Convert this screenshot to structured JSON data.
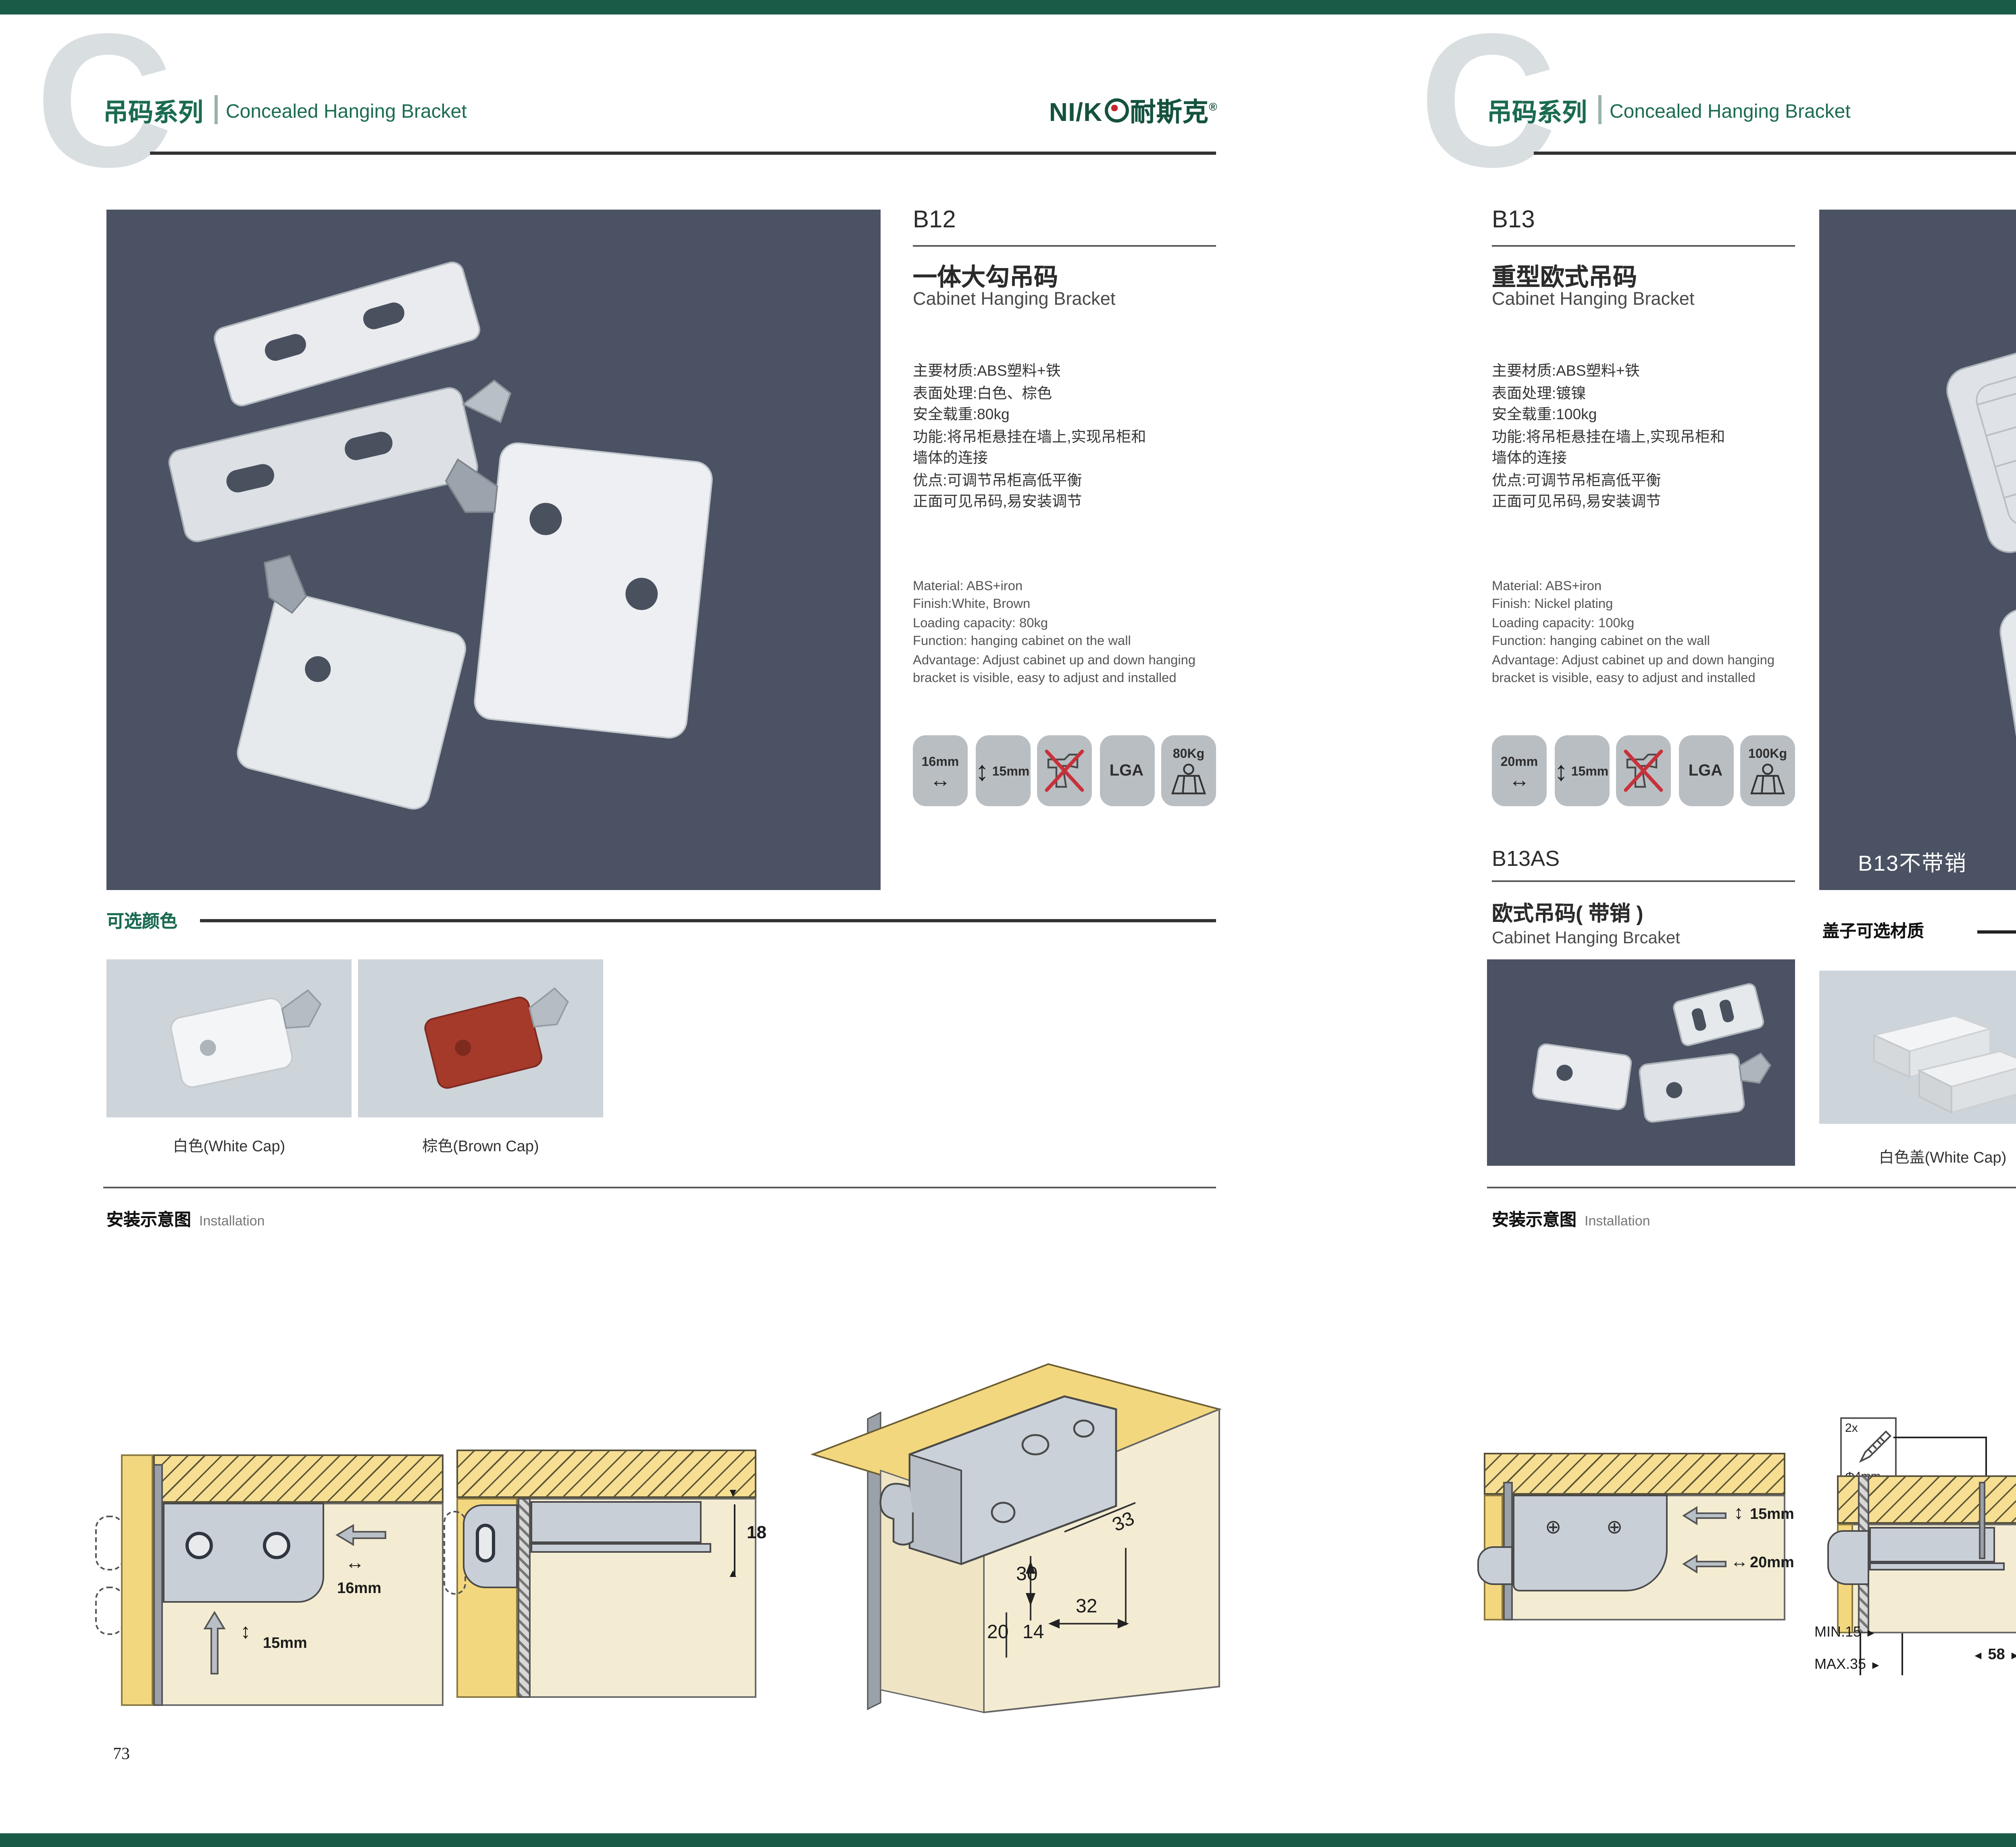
{
  "brand": {
    "logo_latin": "NI/K",
    "logo_cn": "耐斯克",
    "reg": "®"
  },
  "header": {
    "series_cn": "吊码系列",
    "series_en": "Concealed Hanging Bracket",
    "watermark": "C"
  },
  "left": {
    "code": "B12",
    "name_cn": "一体大勾吊码",
    "name_en": "Cabinet Hanging Bracket",
    "specs_cn": [
      "主要材质:ABS塑料+铁",
      "表面处理:白色、棕色",
      "安全载重:80kg",
      "功能:将吊柜悬挂在墙上,实现吊柜和",
      "墙体的连接",
      "优点:可调节吊柜高低平衡",
      "正面可见吊码,易安装调节"
    ],
    "specs_en": [
      "Material: ABS+iron",
      "Finish:White, Brown",
      "Loading capacity: 80kg",
      "Function: hanging cabinet on the wall",
      "Advantage: Adjust cabinet up and down hanging",
      "bracket is visible, easy to adjust and installed"
    ],
    "badges": {
      "b1": "16mm",
      "b2": "15mm",
      "b4": "LGA",
      "b5": "80Kg"
    },
    "colors_title": "可选颜色",
    "color1": "白色(White Cap)",
    "color2": "棕色(Brown Cap)",
    "install_cn": "安装示意图",
    "install_en": "Installation",
    "d1": {
      "dim1": "16mm",
      "dim2": "15mm"
    },
    "d2": {
      "dim1": "18"
    },
    "d3": {
      "dim1": "33",
      "dim2": "30",
      "dim3": "32",
      "dim4": "20",
      "dim5": "14"
    },
    "page_no": "73"
  },
  "right": {
    "code": "B13",
    "name_cn": "重型欧式吊码",
    "name_en": "Cabinet Hanging Bracket",
    "specs_cn": [
      "主要材质:ABS塑料+铁",
      "表面处理:镀镍",
      "安全载重:100kg",
      "功能:将吊柜悬挂在墙上,实现吊柜和",
      "墙体的连接",
      "优点:可调节吊柜高低平衡",
      "正面可见吊码,易安装调节"
    ],
    "specs_en": [
      "Material: ABS+iron",
      "Finish: Nickel plating",
      "Loading capacity: 100kg",
      "Function: hanging cabinet on the wall",
      "Advantage: Adjust cabinet up and down hanging",
      "bracket is visible, easy to adjust and installed"
    ],
    "badges": {
      "b1": "20mm",
      "b2": "15mm",
      "b4": "LGA",
      "b5": "100Kg"
    },
    "photo_label": "B13不带销",
    "sub_code": "B13AS",
    "sub_name_cn": "欧式吊码( 带销 )",
    "sub_name_en": "Cabinet Hanging Brcaket",
    "caps_title": "盖子可选材质",
    "cap1": "白色盖(White Cap)",
    "cap2": "灰色盖(Gray Cap)",
    "install_cn": "安装示意图",
    "install_en": "Installation",
    "dA": {
      "dim1": "15mm",
      "dim2": "20mm"
    },
    "dB": {
      "qty": "2x",
      "dia": "Φ4mm",
      "dim1": "18",
      "dim2": "MIN.15",
      "dim3": "MAX.35",
      "dim4": "58"
    },
    "dC": {
      "dim1": "16",
      "dim2": "40",
      "dim3": "RMAX4",
      "dim4": "19",
      "dim5": "18",
      "dim6": "32"
    },
    "page_no": "74"
  },
  "colors": {
    "accent_green": "#1B6B52",
    "bar_green": "#1A5B47",
    "photo_bg": "#4A5263",
    "swatch_bg": "#CDD4DA",
    "badge_bg": "#B9BEC3"
  }
}
